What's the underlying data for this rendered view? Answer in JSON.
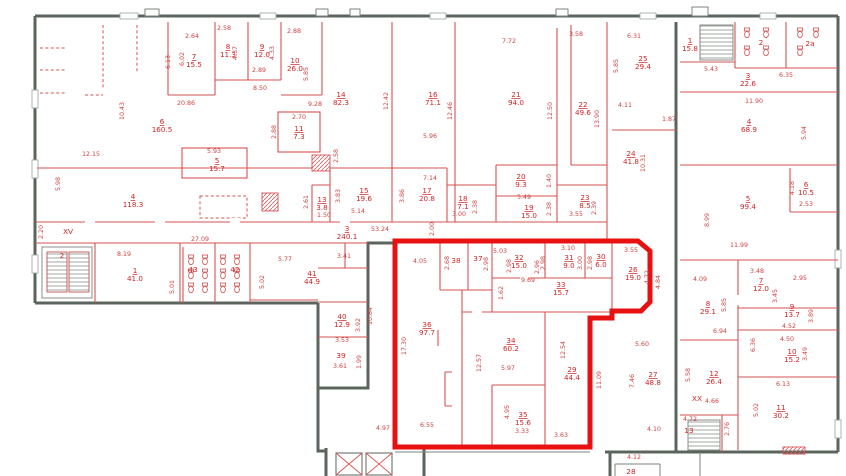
{
  "colors": {
    "outer_wall": "#5b655d",
    "partition": "#d65151",
    "label": "#cf2525",
    "highlight_outline": "#e81111",
    "background": "#ffffff"
  },
  "rooms": [
    {
      "n": "7",
      "a": "15.5",
      "x": 194,
      "y": 60
    },
    {
      "n": "8",
      "a": "11.3",
      "x": 228,
      "y": 50
    },
    {
      "n": "9",
      "a": "12.0",
      "x": 262,
      "y": 50
    },
    {
      "n": "10",
      "a": "26.0",
      "x": 295,
      "y": 64
    },
    {
      "n": "11",
      "a": "7.3",
      "x": 299,
      "y": 132
    },
    {
      "n": "14",
      "a": "82.3",
      "x": 341,
      "y": 98
    },
    {
      "n": "6",
      "a": "160.5",
      "x": 162,
      "y": 125
    },
    {
      "n": "4",
      "a": "118.3",
      "x": 133,
      "y": 200
    },
    {
      "n": "5",
      "a": "15.7",
      "x": 217,
      "y": 164
    },
    {
      "n": "16",
      "a": "71.1",
      "x": 433,
      "y": 98
    },
    {
      "n": "21",
      "a": "94.0",
      "x": 516,
      "y": 98
    },
    {
      "n": "22",
      "a": "49.6",
      "x": 583,
      "y": 108
    },
    {
      "n": "25",
      "a": "29.4",
      "x": 643,
      "y": 62
    },
    {
      "n": "1",
      "a": "15.8",
      "x": 690,
      "y": 44
    },
    {
      "n": "3",
      "a": "22.6",
      "x": 748,
      "y": 79
    },
    {
      "n": "4",
      "a": "68.9",
      "x": 749,
      "y": 125
    },
    {
      "n": "24",
      "a": "41.8",
      "x": 631,
      "y": 157
    },
    {
      "n": "5",
      "a": "99.4",
      "x": 748,
      "y": 202
    },
    {
      "n": "6",
      "a": "10.5",
      "x": 806,
      "y": 188
    },
    {
      "n": "13",
      "a": "3.8",
      "x": 322,
      "y": 203
    },
    {
      "n": "15",
      "a": "19.6",
      "x": 364,
      "y": 194
    },
    {
      "n": "17",
      "a": "20.8",
      "x": 427,
      "y": 194
    },
    {
      "n": "18",
      "a": "7.1",
      "x": 463,
      "y": 202
    },
    {
      "n": "20",
      "a": "9.3",
      "x": 521,
      "y": 180
    },
    {
      "n": "19",
      "a": "15.0",
      "x": 529,
      "y": 211
    },
    {
      "n": "23",
      "a": "8.5",
      "x": 585,
      "y": 201
    },
    {
      "n": "3",
      "a": "240.1",
      "x": 347,
      "y": 232
    },
    {
      "n": "1",
      "a": "41.0",
      "x": 135,
      "y": 274
    },
    {
      "n": "41",
      "a": "44.9",
      "x": 312,
      "y": 277
    },
    {
      "n": "40",
      "a": "12.9",
      "x": 342,
      "y": 320
    },
    {
      "n": "26",
      "a": "19.0",
      "x": 633,
      "y": 273
    },
    {
      "n": "7",
      "a": "12.0",
      "x": 761,
      "y": 284
    },
    {
      "n": "8",
      "a": "29.1",
      "x": 708,
      "y": 307
    },
    {
      "n": "9",
      "a": "13.7",
      "x": 792,
      "y": 310
    },
    {
      "n": "10",
      "a": "15.2",
      "x": 792,
      "y": 355
    },
    {
      "n": "12",
      "a": "26.4",
      "x": 714,
      "y": 377
    },
    {
      "n": "27",
      "a": "48.8",
      "x": 653,
      "y": 378
    },
    {
      "n": "11",
      "a": "30.2",
      "x": 781,
      "y": 411
    },
    {
      "n": "36",
      "a": "97.7",
      "x": 427,
      "y": 328
    },
    {
      "n": "34",
      "a": "60.2",
      "x": 511,
      "y": 344
    },
    {
      "n": "35",
      "a": "15.6",
      "x": 523,
      "y": 418
    },
    {
      "n": "29",
      "a": "44.4",
      "x": 572,
      "y": 373
    },
    {
      "n": "32",
      "a": "15.0",
      "x": 519,
      "y": 261
    },
    {
      "n": "31",
      "a": "9.0",
      "x": 569,
      "y": 261
    },
    {
      "n": "30",
      "a": "6.0",
      "x": 601,
      "y": 260
    },
    {
      "n": "33",
      "a": "15.7",
      "x": 561,
      "y": 288
    }
  ],
  "marks": [
    {
      "t": "37",
      "x": 478,
      "y": 261
    },
    {
      "t": "38",
      "x": 456,
      "y": 263
    },
    {
      "t": "39",
      "x": 341,
      "y": 358
    },
    {
      "t": "42",
      "x": 235,
      "y": 272
    },
    {
      "t": "43",
      "x": 193,
      "y": 272
    },
    {
      "t": "2",
      "x": 761,
      "y": 45
    },
    {
      "t": "2a",
      "x": 810,
      "y": 46
    },
    {
      "t": "2",
      "x": 62,
      "y": 258
    },
    {
      "t": "13",
      "x": 689,
      "y": 433
    },
    {
      "t": "28",
      "x": 631,
      "y": 474
    },
    {
      "t": "XV",
      "x": 68,
      "y": 234
    },
    {
      "t": "XX",
      "x": 697,
      "y": 401
    }
  ],
  "dims": [
    {
      "t": "2.64",
      "x": 192,
      "y": 38
    },
    {
      "t": "6.13",
      "x": 170,
      "y": 62,
      "r": 1
    },
    {
      "t": "6.02",
      "x": 184,
      "y": 59,
      "r": 1
    },
    {
      "t": "4.37",
      "x": 237,
      "y": 53,
      "r": 1
    },
    {
      "t": "2.58",
      "x": 224,
      "y": 30
    },
    {
      "t": "4.33",
      "x": 274,
      "y": 53,
      "r": 1
    },
    {
      "t": "2.89",
      "x": 259,
      "y": 72
    },
    {
      "t": "8.50",
      "x": 260,
      "y": 90
    },
    {
      "t": "20.86",
      "x": 186,
      "y": 105
    },
    {
      "t": "10.43",
      "x": 124,
      "y": 111,
      "r": 1
    },
    {
      "t": "12.15",
      "x": 91,
      "y": 156
    },
    {
      "t": "5.93",
      "x": 214,
      "y": 153
    },
    {
      "t": "5.98",
      "x": 60,
      "y": 184,
      "r": 1
    },
    {
      "t": "2.88",
      "x": 294,
      "y": 33
    },
    {
      "t": "5.85",
      "x": 308,
      "y": 74,
      "r": 1
    },
    {
      "t": "9.28",
      "x": 315,
      "y": 106
    },
    {
      "t": "2.70",
      "x": 299,
      "y": 119
    },
    {
      "t": "2.88",
      "x": 276,
      "y": 132,
      "r": 1
    },
    {
      "t": "12.42",
      "x": 388,
      "y": 101,
      "r": 1
    },
    {
      "t": "5.96",
      "x": 430,
      "y": 138
    },
    {
      "t": "7.72",
      "x": 509,
      "y": 43
    },
    {
      "t": "12.46",
      "x": 452,
      "y": 111,
      "r": 1
    },
    {
      "t": "3.58",
      "x": 576,
      "y": 36
    },
    {
      "t": "12.50",
      "x": 552,
      "y": 111,
      "r": 1
    },
    {
      "t": "13.90",
      "x": 599,
      "y": 119,
      "r": 1
    },
    {
      "t": "6.31",
      "x": 634,
      "y": 38
    },
    {
      "t": "5.85",
      "x": 618,
      "y": 66,
      "r": 1
    },
    {
      "t": "5.43",
      "x": 711,
      "y": 71
    },
    {
      "t": "6.35",
      "x": 786,
      "y": 77
    },
    {
      "t": "11.90",
      "x": 754,
      "y": 103
    },
    {
      "t": "4.11",
      "x": 625,
      "y": 107
    },
    {
      "t": "1.87",
      "x": 669,
      "y": 121
    },
    {
      "t": "5.94",
      "x": 806,
      "y": 133,
      "r": 1
    },
    {
      "t": "10.31",
      "x": 645,
      "y": 163,
      "r": 1
    },
    {
      "t": "8.99",
      "x": 709,
      "y": 220,
      "r": 1
    },
    {
      "t": "11.99",
      "x": 739,
      "y": 247
    },
    {
      "t": "4.18",
      "x": 794,
      "y": 188,
      "r": 1
    },
    {
      "t": "2.53",
      "x": 806,
      "y": 206
    },
    {
      "t": "5.14",
      "x": 358,
      "y": 213
    },
    {
      "t": "3.83",
      "x": 340,
      "y": 196,
      "r": 1
    },
    {
      "t": "2.61",
      "x": 308,
      "y": 202,
      "r": 1
    },
    {
      "t": "1.50",
      "x": 324,
      "y": 217
    },
    {
      "t": "2.58",
      "x": 338,
      "y": 156,
      "r": 1
    },
    {
      "t": "7.14",
      "x": 430,
      "y": 180
    },
    {
      "t": "3.86",
      "x": 404,
      "y": 196,
      "r": 1
    },
    {
      "t": "3.00",
      "x": 459,
      "y": 216
    },
    {
      "t": "2.38",
      "x": 477,
      "y": 207,
      "r": 1
    },
    {
      "t": "5.49",
      "x": 524,
      "y": 199
    },
    {
      "t": "1.40",
      "x": 551,
      "y": 181,
      "r": 1
    },
    {
      "t": "2.38",
      "x": 551,
      "y": 209,
      "r": 1
    },
    {
      "t": "3.55",
      "x": 576,
      "y": 216
    },
    {
      "t": "2.39",
      "x": 596,
      "y": 208,
      "r": 1
    },
    {
      "t": "53.24",
      "x": 380,
      "y": 231
    },
    {
      "t": "2.00",
      "x": 434,
      "y": 229,
      "r": 1
    },
    {
      "t": "27.09",
      "x": 200,
      "y": 241
    },
    {
      "t": "2.20",
      "x": 43,
      "y": 232,
      "r": 1
    },
    {
      "t": "8.19",
      "x": 124,
      "y": 256
    },
    {
      "t": "5.01",
      "x": 174,
      "y": 287,
      "r": 1
    },
    {
      "t": "5.77",
      "x": 285,
      "y": 261
    },
    {
      "t": "5.02",
      "x": 264,
      "y": 282,
      "r": 1
    },
    {
      "t": "3.41",
      "x": 344,
      "y": 258
    },
    {
      "t": "3.92",
      "x": 360,
      "y": 325,
      "r": 1
    },
    {
      "t": "3.53",
      "x": 342,
      "y": 342
    },
    {
      "t": "3.61",
      "x": 340,
      "y": 368
    },
    {
      "t": "1.99",
      "x": 361,
      "y": 362,
      "r": 1
    },
    {
      "t": "10.84",
      "x": 372,
      "y": 316,
      "r": 1
    },
    {
      "t": "4.97",
      "x": 383,
      "y": 430
    },
    {
      "t": "4.05",
      "x": 420,
      "y": 263
    },
    {
      "t": "5.03",
      "x": 500,
      "y": 253
    },
    {
      "t": "2.98",
      "x": 511,
      "y": 266,
      "r": 1
    },
    {
      "t": "2.96",
      "x": 539,
      "y": 267,
      "r": 1
    },
    {
      "t": "2.68",
      "x": 449,
      "y": 263,
      "r": 1
    },
    {
      "t": "2.98",
      "x": 488,
      "y": 264,
      "r": 1
    },
    {
      "t": "9.69",
      "x": 528,
      "y": 282
    },
    {
      "t": "1.62",
      "x": 503,
      "y": 293,
      "r": 1
    },
    {
      "t": "3.10",
      "x": 568,
      "y": 250
    },
    {
      "t": "3.00",
      "x": 582,
      "y": 263,
      "r": 1
    },
    {
      "t": "2.98",
      "x": 545,
      "y": 263,
      "r": 1
    },
    {
      "t": "2.98",
      "x": 592,
      "y": 263,
      "r": 1
    },
    {
      "t": "3.55",
      "x": 631,
      "y": 252
    },
    {
      "t": "4.72",
      "x": 649,
      "y": 277,
      "r": 1
    },
    {
      "t": "4.84",
      "x": 660,
      "y": 282,
      "r": 1
    },
    {
      "t": "17.30",
      "x": 406,
      "y": 346,
      "r": 1
    },
    {
      "t": "6.55",
      "x": 427,
      "y": 427
    },
    {
      "t": "12.57",
      "x": 481,
      "y": 363,
      "r": 1
    },
    {
      "t": "5.97",
      "x": 508,
      "y": 370
    },
    {
      "t": "4.95",
      "x": 509,
      "y": 412,
      "r": 1
    },
    {
      "t": "3.33",
      "x": 522,
      "y": 433
    },
    {
      "t": "12.54",
      "x": 565,
      "y": 350,
      "r": 1
    },
    {
      "t": "3.63",
      "x": 561,
      "y": 437
    },
    {
      "t": "11.09",
      "x": 601,
      "y": 380,
      "r": 1
    },
    {
      "t": "3.48",
      "x": 757,
      "y": 273
    },
    {
      "t": "2.95",
      "x": 800,
      "y": 280
    },
    {
      "t": "4.09",
      "x": 700,
      "y": 281
    },
    {
      "t": "3.45",
      "x": 777,
      "y": 296,
      "r": 1
    },
    {
      "t": "5.85",
      "x": 726,
      "y": 305,
      "r": 1
    },
    {
      "t": "6.94",
      "x": 720,
      "y": 333
    },
    {
      "t": "3.89",
      "x": 813,
      "y": 316,
      "r": 1
    },
    {
      "t": "4.52",
      "x": 789,
      "y": 328
    },
    {
      "t": "4.50",
      "x": 787,
      "y": 341
    },
    {
      "t": "3.49",
      "x": 807,
      "y": 354,
      "r": 1
    },
    {
      "t": "6.13",
      "x": 783,
      "y": 386
    },
    {
      "t": "5.02",
      "x": 758,
      "y": 410,
      "r": 1
    },
    {
      "t": "4.66",
      "x": 712,
      "y": 403
    },
    {
      "t": "5.58",
      "x": 690,
      "y": 375,
      "r": 1
    },
    {
      "t": "6.36",
      "x": 755,
      "y": 345,
      "r": 1
    },
    {
      "t": "5.60",
      "x": 642,
      "y": 346
    },
    {
      "t": "7.46",
      "x": 634,
      "y": 381,
      "r": 1
    },
    {
      "t": "4.10",
      "x": 654,
      "y": 431
    },
    {
      "t": "4.12",
      "x": 634,
      "y": 459
    },
    {
      "t": "4.72",
      "x": 690,
      "y": 421
    },
    {
      "t": "2.76",
      "x": 729,
      "y": 429,
      "r": 1
    }
  ]
}
